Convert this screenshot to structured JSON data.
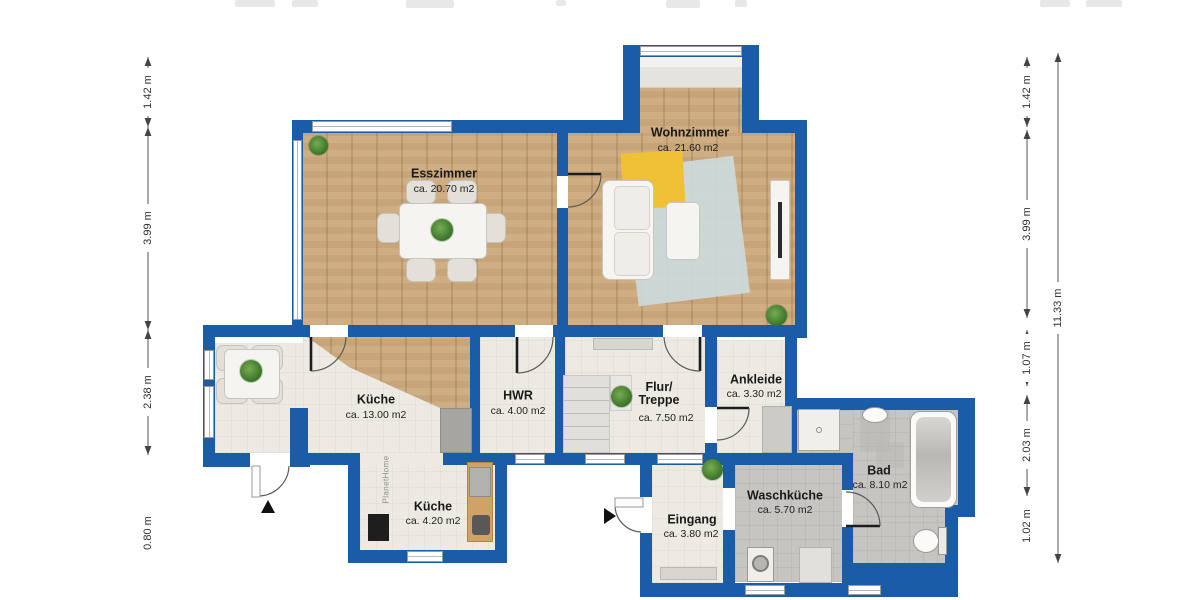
{
  "watermark": "PlanetHome",
  "rooms": [
    {
      "name": "Esszimmer",
      "area": "ca. 20.70 m2"
    },
    {
      "name": "Wohnzimmer",
      "area": "ca. 21.60 m2"
    },
    {
      "name": "Küche",
      "area": "ca. 13.00 m2"
    },
    {
      "name": "HWR",
      "area": "ca. 4.00 m2"
    },
    {
      "name": "Flur/ Treppe",
      "area": "ca. 7.50 m2"
    },
    {
      "name": "Ankleide",
      "area": "ca. 3.30 m2"
    },
    {
      "name": "Küche",
      "area": "ca. 4.20 m2"
    },
    {
      "name": "Eingang",
      "area": "ca. 3.80 m2"
    },
    {
      "name": "Waschküche",
      "area": "ca. 5.70 m2"
    },
    {
      "name": "Bad",
      "area": "ca. 8.10 m2"
    }
  ],
  "dimensions": {
    "left": [
      "1.42 m",
      "3.99 m",
      "2.38 m",
      "0.80 m"
    ],
    "right": [
      "1.42 m",
      "3.99 m",
      "1.07 m",
      "2.03 m",
      "1.02 m"
    ],
    "total": "11.33 m"
  },
  "colors": {
    "wall_blue": "#1b5ca8",
    "wood_floor": "#cdaa7d",
    "light_floor": "#edeae3",
    "tile_floor": "#c7c5c1",
    "rug_yellow": "#f0c135",
    "rug_blue": "#ccdbdf",
    "plant_green": "#4a7f35"
  }
}
